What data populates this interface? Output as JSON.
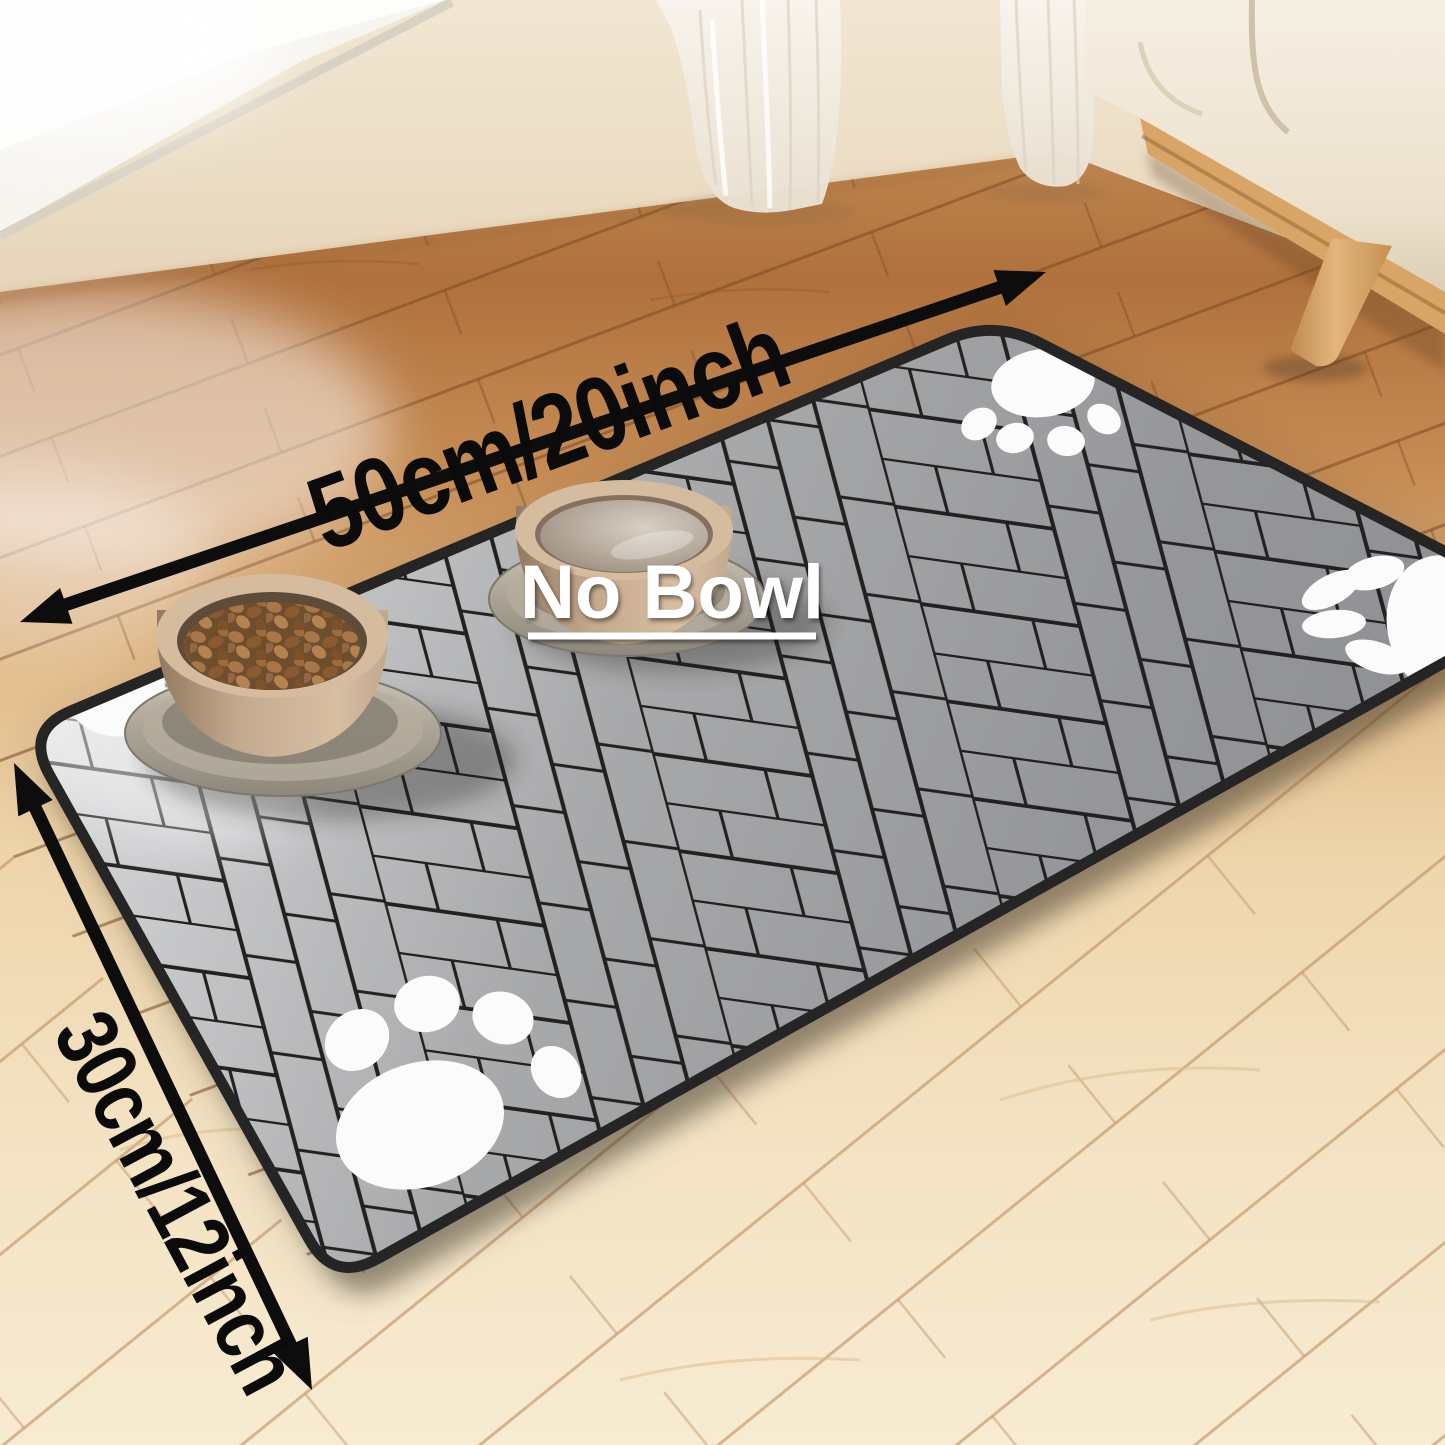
{
  "title": "Pet feeding mat product photo",
  "labels": {
    "width": "50cm/20inch",
    "depth": "30cm/12inch",
    "no_bowl": "No Bowl"
  },
  "mat": {
    "shape": "rounded rectangle shown in perspective",
    "pattern": "herringbone planks",
    "base_color": "#9b9c9e",
    "highlight_color": "#d4d5d7",
    "plank_line_color": "#212122",
    "edge_color": "#252525",
    "paw_print_count": 4,
    "paw_print_color": "#fbfbfb"
  },
  "bowls": [
    {
      "type": "food-bowl",
      "contents": "kibble",
      "body_color": "#c6ac90",
      "kibble_color": "#8a5a30",
      "tray_color": "#b3aca0"
    },
    {
      "type": "water-bowl",
      "contents": "water",
      "body_color": "#c6ac90",
      "water_color": "#b7ab9d",
      "tray_color": "#b3aca0"
    }
  ],
  "annotations": {
    "arrow_color": "#0d0d0d",
    "dimension_text_color": "#0b0b0b",
    "no_bowl_text_color": "#ffffff",
    "no_bowl_underlined": true,
    "arrows": [
      {
        "name": "width-arrow",
        "double_headed": true,
        "label": "50cm/20inch"
      },
      {
        "name": "depth-arrow",
        "double_headed": true,
        "label": "30cm/12inch"
      }
    ]
  },
  "environment": {
    "floor_far_color": "#b0713d",
    "floor_near_color": "#f6e9cd",
    "wall_color": "#ead9c3",
    "window_sill_color": "#f7f5f0",
    "curtain_color": "#f6f1e9",
    "cabinet_color": "#f2ebdd",
    "cabinet_leg_color": "#d9a869"
  }
}
